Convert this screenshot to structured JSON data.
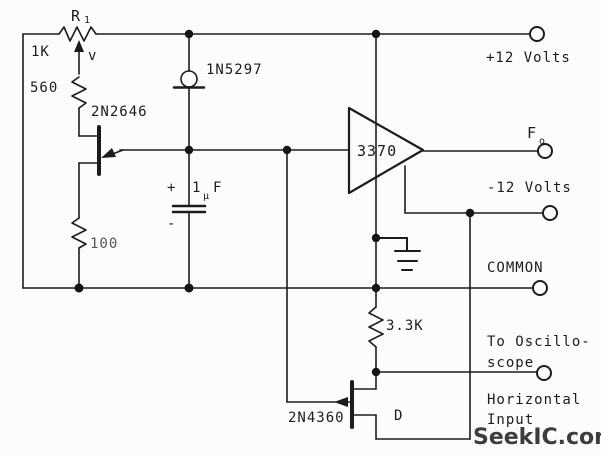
{
  "diagram": {
    "type": "circuit-schematic",
    "description": "UJT relaxation oscillator with 3370 buffer driving oscilloscope horizontal input",
    "ink_color": "#1c1c1c",
    "background": "#fcfcfc"
  },
  "labels": {
    "r1_name": "R",
    "r1_subscript": "1",
    "r1_value": "1K",
    "wiper_mark": "v",
    "r560_value": "560",
    "ujt_part": "2N2646",
    "crd_part": "1N5297",
    "r100_value": "100",
    "cap_plus": "+",
    "cap_minus": "-",
    "cap_value_num": "1",
    "cap_value_mu": "μ",
    "cap_value_unit": "F",
    "opamp_part": "3370",
    "r33k_value": "3.3K",
    "jfet_part": "2N4360",
    "jfet_drain": "D",
    "terminal_plus12": "+12 Volts",
    "terminal_fo_main": "F",
    "terminal_fo_sub": "o",
    "terminal_minus12": "-12 Volts",
    "terminal_common": "COMMON",
    "scope_line1": "To Oscillo-",
    "scope_line2": "scope",
    "scope_line3": "Horizontal",
    "scope_line4": "Input",
    "watermark": "SeekIC.com"
  }
}
